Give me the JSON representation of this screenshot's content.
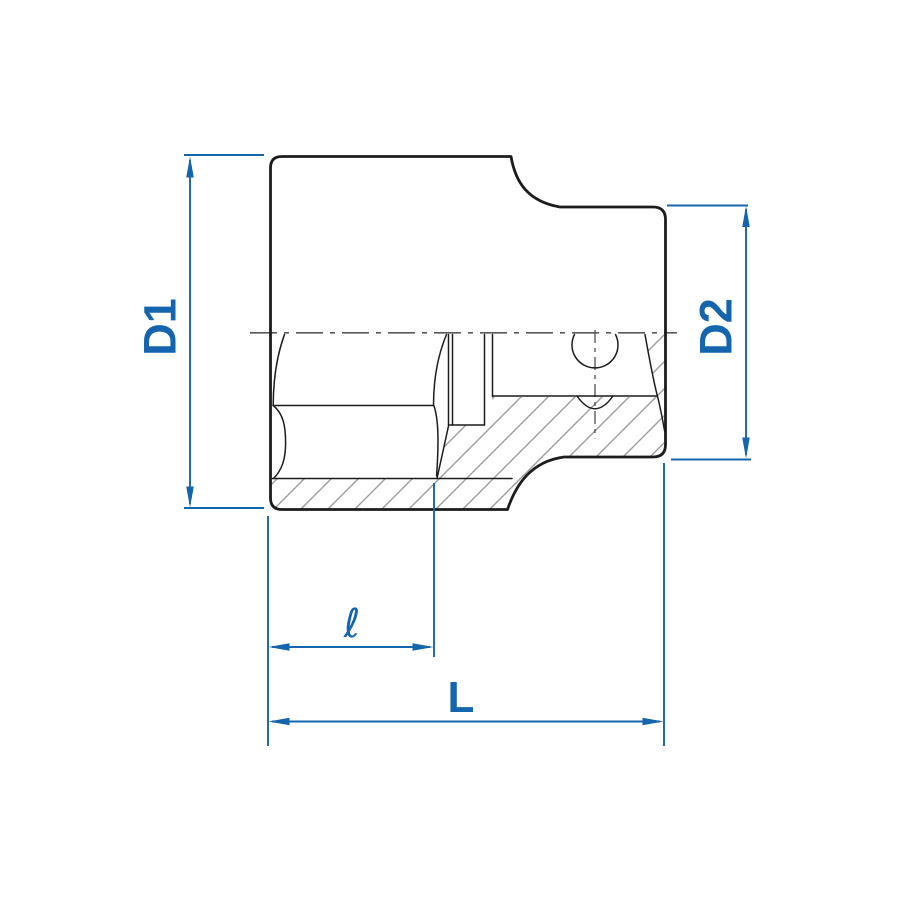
{
  "drawing": {
    "title": "Socket cross-section technical drawing",
    "dimensions": {
      "d1": "D1",
      "d2": "D2",
      "l_small": "ℓ",
      "l_total": "L"
    },
    "colors": {
      "dimension": "#1565ae",
      "outline": "#1c1c1c",
      "hatch": "#9c9c9c",
      "centerline": "#5a5a5a",
      "background": "#ffffff"
    }
  }
}
